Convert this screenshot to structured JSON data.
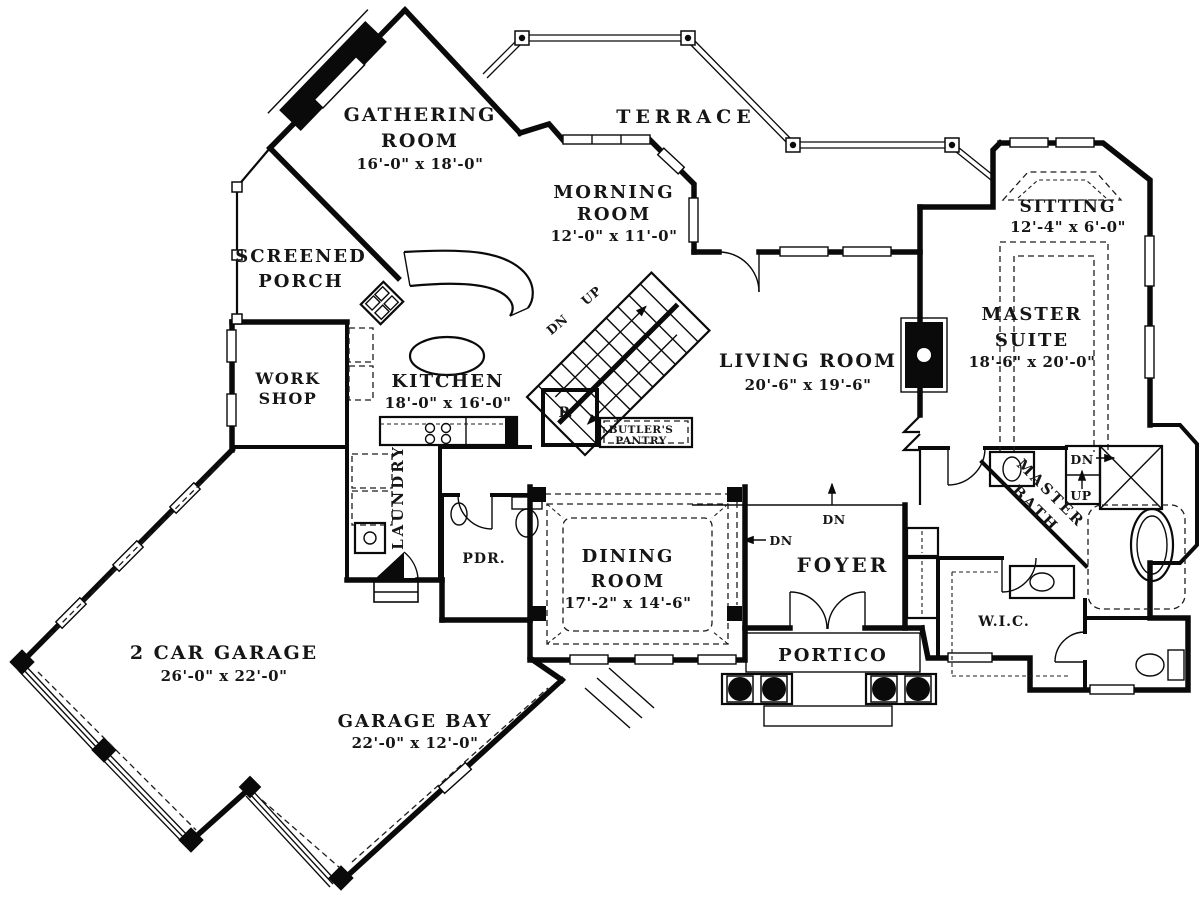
{
  "rooms": {
    "gathering_room": {
      "name_line1": "GATHERING",
      "name_line2": "ROOM",
      "dims": "16'-0\" x 18'-0\""
    },
    "terrace": {
      "name_line1": "TERRACE"
    },
    "morning_room": {
      "name_line1": "MORNING",
      "name_line2": "ROOM",
      "dims": "12'-0\" x 11'-0\""
    },
    "screened_porch": {
      "name_line1": "SCREENED",
      "name_line2": "PORCH"
    },
    "sitting": {
      "name_line1": "SITTING",
      "dims": "12'-4\" x 6'-0\""
    },
    "master_suite": {
      "name_line1": "MASTER",
      "name_line2": "SUITE",
      "dims": "18'-6\" x 20'-0\""
    },
    "living_room": {
      "name_line1": "LIVING ROOM",
      "dims": "20'-6\" x 19'-6\""
    },
    "work_shop": {
      "name_line1": "WORK",
      "name_line2": "SHOP"
    },
    "kitchen": {
      "name_line1": "KITCHEN",
      "dims": "18'-0\" x 16'-0\""
    },
    "laundry": {
      "name_line1": "LAUNDRY"
    },
    "powder_room": {
      "name_line1": "PDR."
    },
    "pantry_closet": {
      "name_line1": "P."
    },
    "butlers_pantry": {
      "name_line1": "BUTLER'S",
      "name_line2": "PANTRY"
    },
    "dining_room": {
      "name_line1": "DINING",
      "name_line2": "ROOM",
      "dims": "17'-2\" x 14'-6\""
    },
    "foyer": {
      "name_line1": "FOYER"
    },
    "portico": {
      "name_line1": "PORTICO"
    },
    "master_bath": {
      "name_line1": "MASTER",
      "name_line2": "BATH"
    },
    "wic": {
      "name_line1": "W.I.C."
    },
    "garage": {
      "name_line1": "2 CAR GARAGE",
      "dims": "26'-0\" x 22'-0\""
    },
    "garage_bay": {
      "name_line1": "GARAGE BAY",
      "dims": "22'-0\" x 12'-0\""
    }
  },
  "stairs": {
    "up_label": "UP",
    "down_label": "DN"
  },
  "annotations": {
    "foyer_step_down": "DN",
    "dining_step_down": "DN",
    "master_stair_down": "DN",
    "master_stair_up": "UP"
  },
  "colors": {
    "walls": "#0a0a0a",
    "paper": "#ffffff",
    "text": "#161616"
  }
}
